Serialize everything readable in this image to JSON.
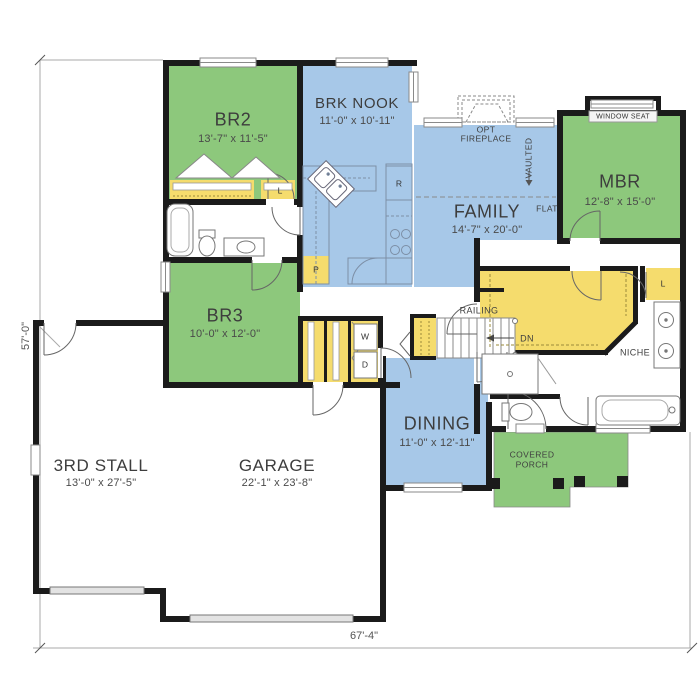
{
  "title": "First floor plan",
  "rooms": {
    "br2": {
      "name": "BR2",
      "dims": "13'-7\" x 11'-5\""
    },
    "brk_nook": {
      "name": "BRK NOOK",
      "dims": "11'-0\" x 10'-11\""
    },
    "mbr": {
      "name": "MBR",
      "dims": "12'-8\" x 15'-0\""
    },
    "family": {
      "name": "FAMILY",
      "dims": "14'-7\" x 20'-0\""
    },
    "br3": {
      "name": "BR3",
      "dims": "10'-0\" x 12'-0\""
    },
    "dining": {
      "name": "DINING",
      "dims": "11'-0\" x 12'-11\""
    },
    "garage": {
      "name": "GARAGE",
      "dims": "22'-1\" x 23'-8\""
    },
    "third_stall": {
      "name": "3RD STALL",
      "dims": "13'-0\" x 27'-5\""
    },
    "covered_porch": {
      "line1": "COVERED",
      "line2": "PORCH"
    }
  },
  "labels": {
    "opt_fireplace_1": "OPT",
    "opt_fireplace_2": "FIREPLACE",
    "vaulted": "VAULTED",
    "flat": "FLAT",
    "window_seat": "WINDOW SEAT",
    "railing": "RAILING",
    "down": "DN",
    "niche": "NICHE",
    "linen_hall": "L",
    "linen_master": "L",
    "pantry_kitchen": "P",
    "washer": "W",
    "dryer": "D",
    "refrigerator": "R"
  },
  "dimensions": {
    "overall_width": "67'-4\"",
    "overall_depth": "57'-0\""
  },
  "colors": {
    "bedroom_green": "#8dc87c",
    "living_blue": "#a7c8e8",
    "closet_yellow": "#f5dc6d",
    "wall_black": "#1b1b1b",
    "dim_gray": "#a8a8a8"
  }
}
